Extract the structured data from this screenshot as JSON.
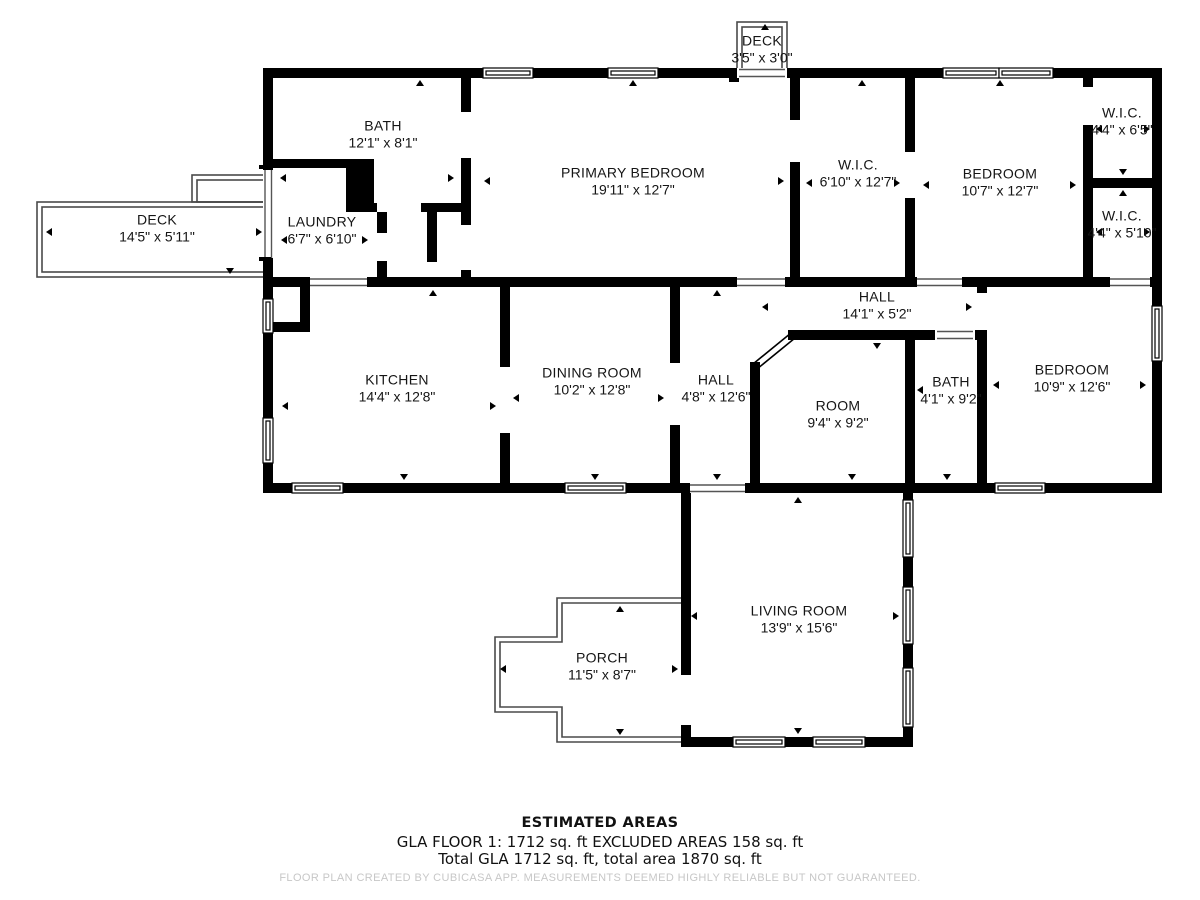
{
  "floorplan": {
    "rooms": [
      {
        "id": "deck-top",
        "name": "DECK",
        "dims": "3'5\" x 3'0\""
      },
      {
        "id": "bath-main",
        "name": "BATH",
        "dims": "12'1\" x 8'1\""
      },
      {
        "id": "primary-bedroom",
        "name": "PRIMARY BEDROOM",
        "dims": "19'11\" x 12'7\""
      },
      {
        "id": "wic-center",
        "name": "W.I.C.",
        "dims": "6'10\" x 12'7\""
      },
      {
        "id": "bedroom-top",
        "name": "BEDROOM",
        "dims": "10'7\" x 12'7\""
      },
      {
        "id": "wic-upper-right",
        "name": "W.I.C.",
        "dims": "4'4\" x 6'5\""
      },
      {
        "id": "wic-lower-right",
        "name": "W.I.C.",
        "dims": "4'4\" x 5'10\""
      },
      {
        "id": "deck-left",
        "name": "DECK",
        "dims": "14'5\" x 5'11\""
      },
      {
        "id": "laundry",
        "name": "LAUNDRY",
        "dims": "6'7\" x 6'10\""
      },
      {
        "id": "kitchen",
        "name": "KITCHEN",
        "dims": "14'4\" x 12'8\""
      },
      {
        "id": "dining-room",
        "name": "DINING ROOM",
        "dims": "10'2\" x 12'8\""
      },
      {
        "id": "hall-vertical",
        "name": "HALL",
        "dims": "4'8\" x 12'6\""
      },
      {
        "id": "hall-horizontal",
        "name": "HALL",
        "dims": "14'1\" x 5'2\""
      },
      {
        "id": "room",
        "name": "ROOM",
        "dims": "9'4\" x 9'2\""
      },
      {
        "id": "bath-small",
        "name": "BATH",
        "dims": "4'1\" x 9'2\""
      },
      {
        "id": "bedroom-right",
        "name": "BEDROOM",
        "dims": "10'9\" x 12'6\""
      },
      {
        "id": "living-room",
        "name": "LIVING ROOM",
        "dims": "13'9\" x 15'6\""
      },
      {
        "id": "porch",
        "name": "PORCH",
        "dims": "11'5\" x 8'7\""
      }
    ],
    "summary": {
      "heading": "ESTIMATED AREAS",
      "line1": "GLA FLOOR 1: 1712 sq. ft EXCLUDED AREAS 158 sq. ft",
      "line2": "Total GLA 1712 sq. ft, total area 1870 sq. ft",
      "disclaimer": "FLOOR PLAN CREATED BY CUBICASA APP. MEASUREMENTS DEEMED HIGHLY RELIABLE BUT NOT GUARANTEED."
    },
    "colors": {
      "wall": "#000000",
      "outline": "#4a4a4a",
      "disclaimer_text": "#c7c7c7"
    }
  }
}
